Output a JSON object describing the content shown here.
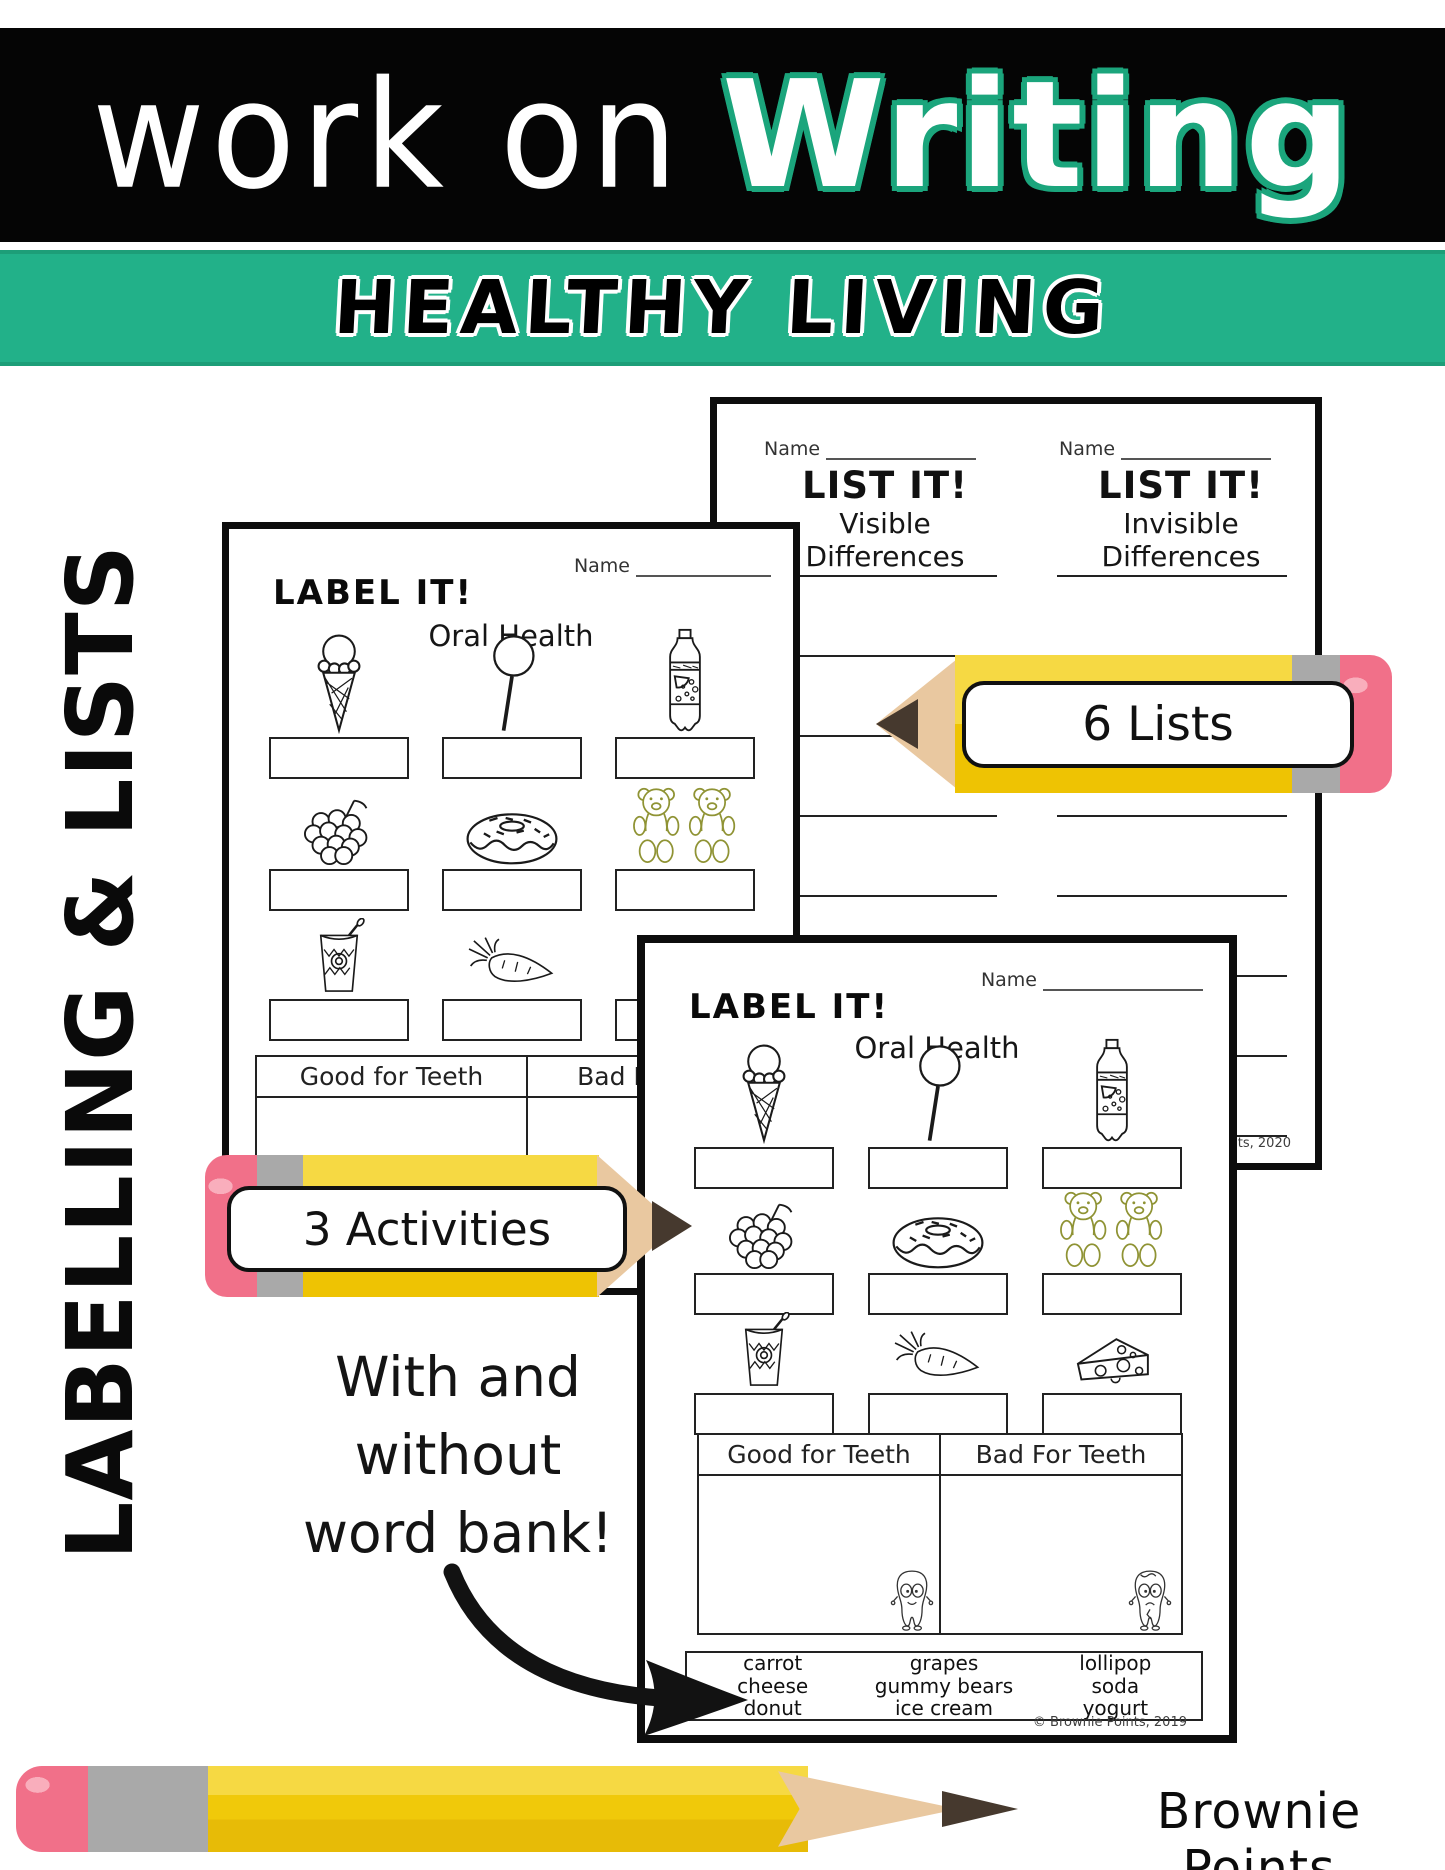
{
  "banner": {
    "title_thin": "work on",
    "title_bold": "Writing",
    "subtitle": "HEALTHY LIVING"
  },
  "side_label": "LABELLING & LISTS",
  "pencil_callouts": {
    "lists": "6 Lists",
    "activities": "3 Activities"
  },
  "note": {
    "line1": "With and",
    "line2": "without",
    "line3": "word bank!"
  },
  "list_sheet": {
    "name_label": "Name",
    "col_left": {
      "title": "LIST IT!",
      "subtitle": "Visible Differences"
    },
    "col_right": {
      "title": "LIST IT!",
      "subtitle": "Invisible Differences"
    },
    "copyright": "© Brownie Points, 2020"
  },
  "label_sheet": {
    "title": "LABEL IT!",
    "name_label": "Name",
    "subtitle": "Oral Health",
    "table": {
      "left_header": "Good for Teeth",
      "right_header": "Bad For Teeth"
    },
    "word_bank": [
      [
        "carrot",
        "cheese",
        "donut"
      ],
      [
        "grapes",
        "gummy bears",
        "ice cream"
      ],
      [
        "lollipop",
        "soda",
        "yogurt"
      ]
    ],
    "copyright": "© Brownie Points, 2019",
    "icons": [
      "ice-cream-icon",
      "lollipop-icon",
      "soda-bottle-icon",
      "grapes-icon",
      "donut-icon",
      "gummy-bears-icon",
      "yogurt-icon",
      "carrot-icon",
      "cheese-icon"
    ]
  },
  "brand": "Brownie Points",
  "colors": {
    "green": "#22b189",
    "outline_green": "#1ba57c",
    "pencil_yellow_light": "#f6d943",
    "pencil_yellow_dark": "#eec303",
    "pencil_wood": "#e9c8a0",
    "pencil_point": "#46392e",
    "ferrule": "#a9a9a9",
    "eraser": "#f17089",
    "gummy_green": "#8f9334"
  }
}
